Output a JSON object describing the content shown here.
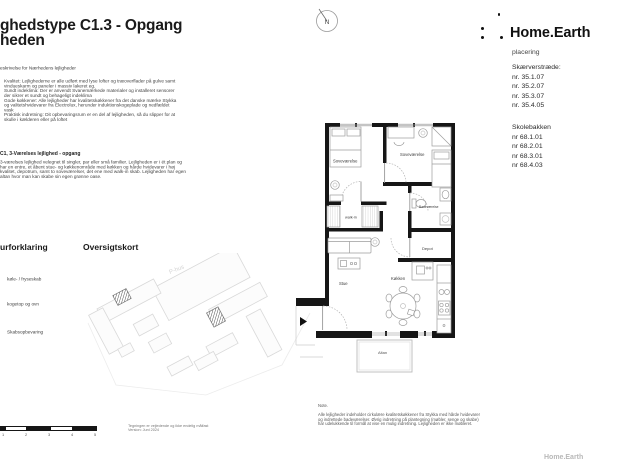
{
  "header": {
    "title_visible": "ghedstype C1.3 - Opgang",
    "project_visible": "heden"
  },
  "description": {
    "heading_visible": "eskrivelse for Nærhedens lejligheder",
    "paragraphs": [
      "Kvalitet: Lejlighederne er alle udført med lyse lofter og træoverflader på gulve samt vindueskarm og paneler i massiv lakeret eg.",
      "Sundt indeklima: Der er anvendt Svanemærkede materialer og installeret sensorer der sikrer et sundt og behageligt indeklima",
      "Gode køkkener: Alle lejligheder har kvalitetskøkkener fra det danske mærke Stykka og valitetshvidevarer fra Electrolux, herunder induktionskogeplade og nedfældet vask",
      "Praktisk indretning: Dit opbevaringsrum er en del af lejligheden, så du slipper for at skulle i kælderen eller på loftet"
    ]
  },
  "apartment": {
    "heading": "C1, 3-Værelses lejlighed - opgang",
    "body": "3-værelses lejlighed velegnet til singler, par eller små familier. Lejligheden er i ét plan og har en entre, et åbent stue- og køkkenområde med køkken og hårde hvidevarer i høj kvalitet, depotrum, samt to soveværelser, det ene med walk-in skab. Lejligheden har egen altan hvor man kan skabe sin egen grønne oase."
  },
  "legend": {
    "heading_visible": "urforklaring",
    "items": [
      "køle- / fryseskab",
      "kogetop og ovn",
      "Skabsopbevaring"
    ]
  },
  "overview": {
    "heading": "Oversigtskort",
    "parking_label": "P-hus"
  },
  "scalebar": {
    "tick_labels": [
      "1",
      "2",
      "3",
      "4",
      "5"
    ]
  },
  "disclaimer": {
    "line1": "Tegningen er vejledende og ikke endelig målfast",
    "line2": "Version: Juni 2024"
  },
  "brand": {
    "name": "Home.Earth",
    "footer": "Home.Earth"
  },
  "placering": {
    "heading": "placering",
    "groups": [
      {
        "street": "Skærverstræde:",
        "units": [
          "nr. 35.1.07",
          "nr. 35.2.07",
          "nr. 35.3.07",
          "nr. 35.4.05"
        ]
      },
      {
        "street": "Skolebakken",
        "units": [
          "nr 68.1.01",
          "nr 68.2.01",
          "nr 68.3.01",
          "nr 68.4.03"
        ]
      }
    ]
  },
  "plan": {
    "compass": "N",
    "labels": {
      "bedroom1": "Soveværelse",
      "bedroom2": "Soveværelse",
      "walkin": "walk-in",
      "bathroom": "Badeværelse",
      "depot": "Depot",
      "stue": "Stue",
      "kitchen": "Køkken",
      "altan": "Altan"
    }
  },
  "note": {
    "heading": "Note.",
    "body": "Alle lejligheder indeholder cirkulære kvalitetskøkkener fra Stykka med hårde hvidevarer og indrettede badeværelser. Øvrig indretning på plantegning (møbler, senge og skabe) har udelukkende til formål at vise en mulig indretning. Lejligheden er ikke møbleret."
  }
}
